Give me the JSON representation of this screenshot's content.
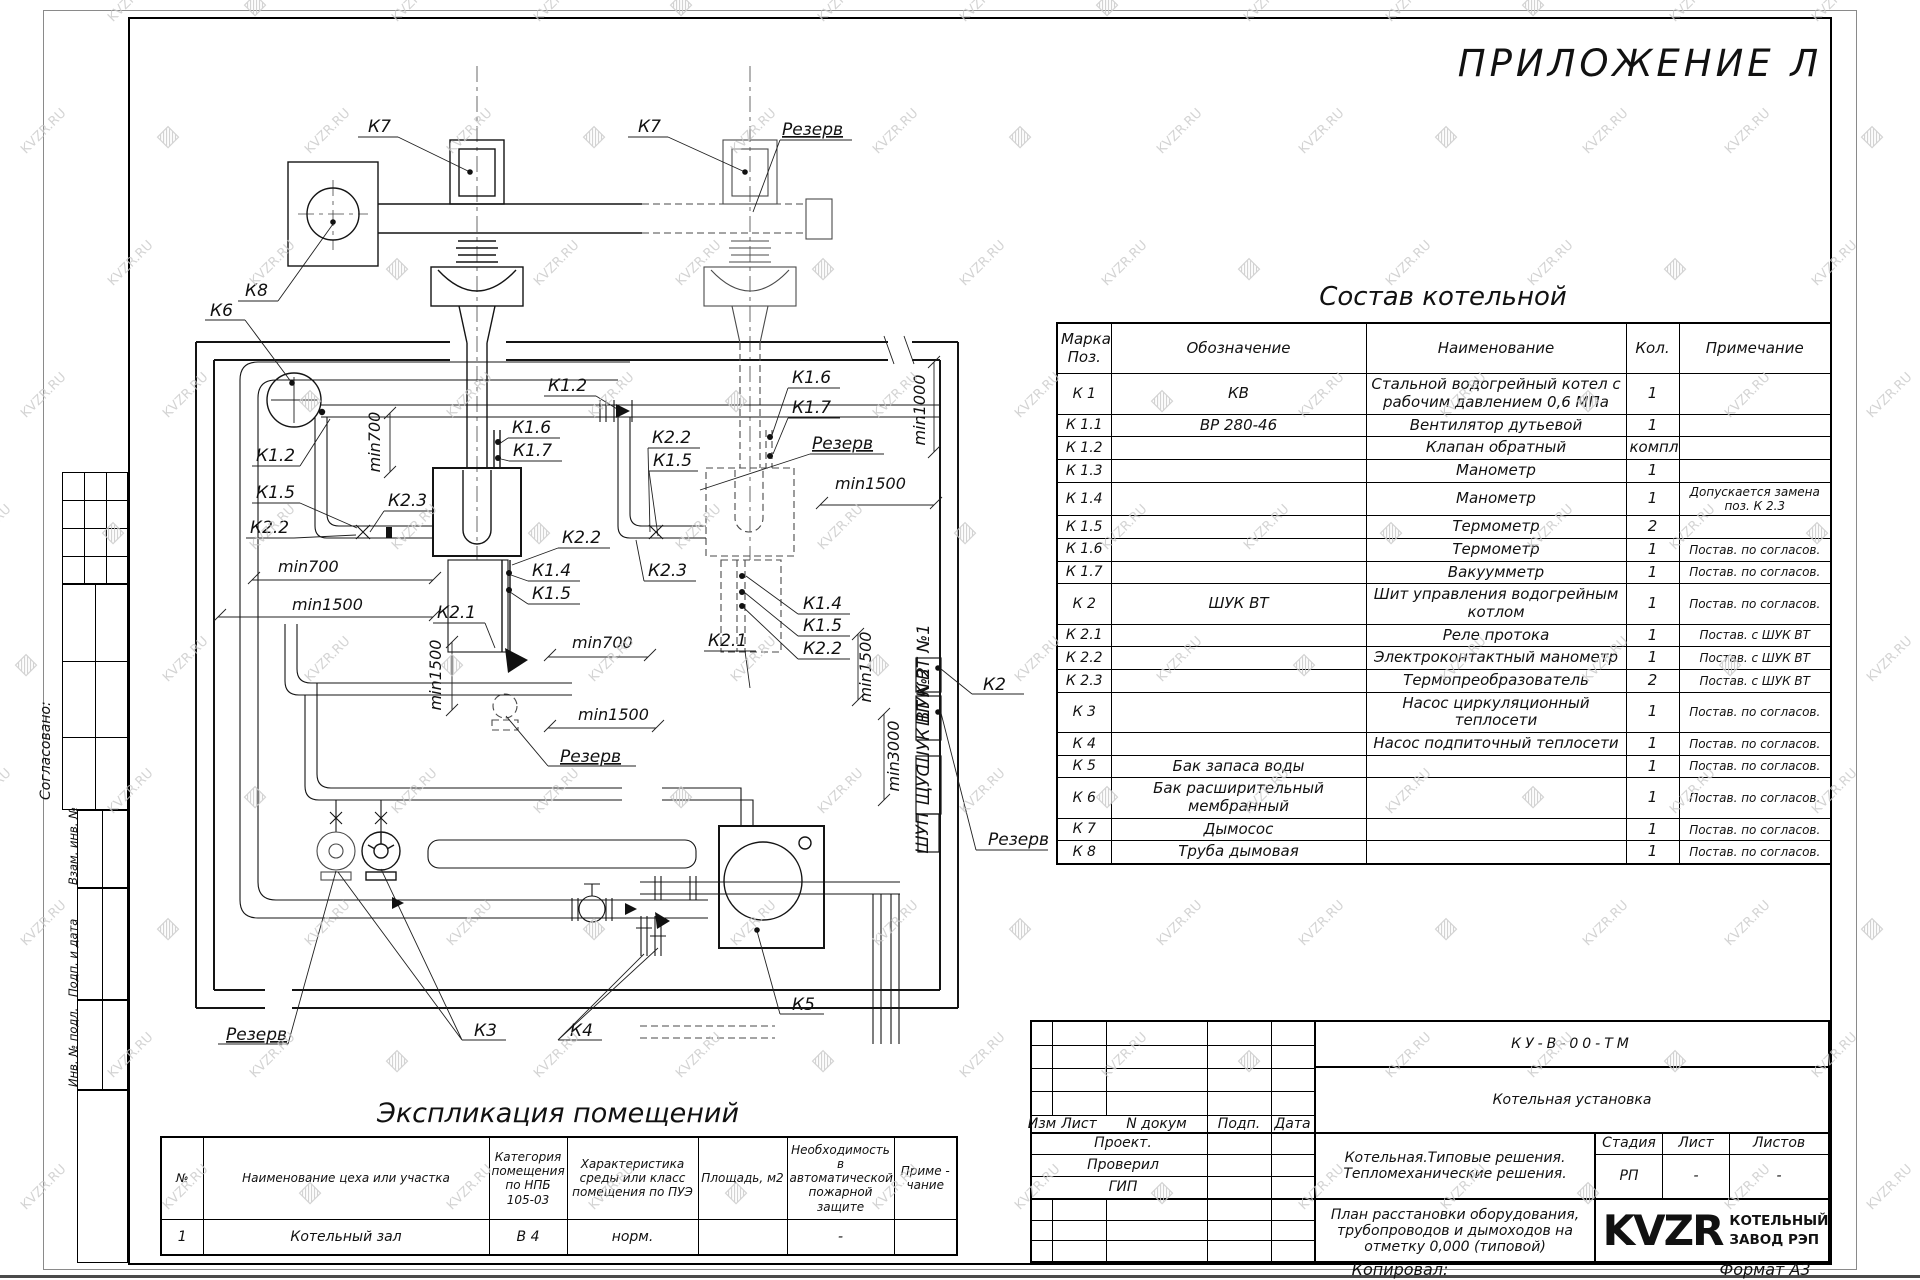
{
  "page": {
    "title": "ПРИЛОЖЕНИЕ Л",
    "copied_label": "Копировал:",
    "format_label": "Формат А3"
  },
  "watermark": {
    "text": "KVZR.RU",
    "color": "#c9c9c9"
  },
  "margin": {
    "agreed": "Согласовано:",
    "replace_inv": "Взам. инв. №",
    "sign_date": "Подп. и дата",
    "inv_orig": "Инв. № подл."
  },
  "composition_table": {
    "title": "Состав котельной",
    "headers": [
      "Марка Поз.",
      "Обозначение",
      "Наименование",
      "Кол.",
      "Примечание"
    ],
    "rows": [
      [
        "К 1",
        "КВ",
        "Стальной водогрейный котел с рабочим давлением 0,6 МПа",
        "1",
        ""
      ],
      [
        "К 1.1",
        "ВР 280-46",
        "Вентилятор дутьевой",
        "1",
        ""
      ],
      [
        "К 1.2",
        "",
        "Клапан обратный",
        "компл.",
        ""
      ],
      [
        "К 1.3",
        "",
        "Манометр",
        "1",
        ""
      ],
      [
        "К 1.4",
        "",
        "Манометр",
        "1",
        "Допускается замена поз. К 2.3"
      ],
      [
        "К 1.5",
        "",
        "Термометр",
        "2",
        ""
      ],
      [
        "К 1.6",
        "",
        "Термометр",
        "1",
        "Постав. по согласов."
      ],
      [
        "К 1.7",
        "",
        "Вакуумметр",
        "1",
        "Постав. по согласов."
      ],
      [
        "К 2",
        "ШУК ВТ",
        "Шит управления водогрейным котлом",
        "1",
        "Постав. по согласов."
      ],
      [
        "К 2.1",
        "",
        "Реле протока",
        "1",
        "Постав. с ШУК ВТ"
      ],
      [
        "К 2.2",
        "",
        "Электроконтактный манометр",
        "1",
        "Постав. с ШУК ВТ"
      ],
      [
        "К 2.3",
        "",
        "Термопреобразователь",
        "2",
        "Постав. с ШУК ВТ"
      ],
      [
        "К 3",
        "",
        "Насос циркуляционный теплосети",
        "1",
        "Постав. по согласов."
      ],
      [
        "К 4",
        "",
        "Насос подпиточный теплосети",
        "1",
        "Постав. по согласов."
      ],
      [
        "К 5",
        "Бак запаса воды",
        "",
        "1",
        "Постав. по согласов."
      ],
      [
        "К 6",
        "Бак расширительный мембранный",
        "",
        "1",
        "Постав. по согласов."
      ],
      [
        "К 7",
        "Дымосос",
        "",
        "1",
        "Постав. по согласов."
      ],
      [
        "К 8",
        "Труба дымовая",
        "",
        "1",
        "Постав. по согласов."
      ]
    ]
  },
  "explication_table": {
    "title": "Экспликация помещений",
    "headers": [
      "№",
      "Наименование цеха или участка",
      "Категория помещения по НПБ 105-03",
      "Характеристика среды или класс помещения по ПУЭ",
      "Площадь, м2",
      "Необходимость в автоматической пожарной защите",
      "Приме - чание"
    ],
    "rows": [
      [
        "1",
        "Котельный зал",
        "В 4",
        "норм.",
        "",
        "-",
        ""
      ]
    ]
  },
  "title_block": {
    "doc_code": "КУ-В-00-ТМ",
    "object_name": "Котельная установка",
    "change_headers": [
      "Изм",
      "Лист",
      "N докум",
      "Подп.",
      "Дата"
    ],
    "roles": [
      "Проект.",
      "Проверил",
      "ГИП"
    ],
    "project_lines": [
      "Котельная.Типовые решения.",
      "Тепломеханические решения."
    ],
    "stage_headers": [
      "Стадия",
      "Лист",
      "Листов"
    ],
    "stage_values": [
      "РП",
      "-",
      "-"
    ],
    "sheet_title_lines": [
      "План расстановки оборудования,",
      "трубопроводов и дымоходов на",
      "отметку 0,000 (типовой)"
    ],
    "logo_text": "KVZR",
    "company_lines": [
      "КОТЕЛЬНЫЙ",
      "ЗАВОД РЭП"
    ]
  },
  "plan": {
    "labels": [
      {
        "t": "К7",
        "x": 368,
        "y": 132
      },
      {
        "t": "К7",
        "x": 638,
        "y": 132
      },
      {
        "t": "Резерв",
        "x": 782,
        "y": 135,
        "u": 1
      },
      {
        "t": "К8",
        "x": 245,
        "y": 296
      },
      {
        "t": "К6",
        "x": 210,
        "y": 316
      },
      {
        "t": "К1.2",
        "x": 256,
        "y": 461
      },
      {
        "t": "К1.5",
        "x": 256,
        "y": 498
      },
      {
        "t": "К2.2",
        "x": 250,
        "y": 533
      },
      {
        "t": "min700",
        "x": 278,
        "y": 572,
        "d": 1
      },
      {
        "t": "min1500",
        "x": 292,
        "y": 610,
        "d": 1
      },
      {
        "t": "К2.3",
        "x": 388,
        "y": 506
      },
      {
        "t": "min700",
        "x": 380,
        "y": 442,
        "d": 1,
        "r": -90
      },
      {
        "t": "К1.6",
        "x": 512,
        "y": 433
      },
      {
        "t": "К1.7",
        "x": 513,
        "y": 456
      },
      {
        "t": "К1.2",
        "x": 548,
        "y": 391
      },
      {
        "t": "К2.2",
        "x": 562,
        "y": 543
      },
      {
        "t": "К1.4",
        "x": 532,
        "y": 576
      },
      {
        "t": "К1.5",
        "x": 532,
        "y": 599
      },
      {
        "t": "К2.1",
        "x": 437,
        "y": 618
      },
      {
        "t": "min700",
        "x": 572,
        "y": 648,
        "d": 1
      },
      {
        "t": "К1.6",
        "x": 792,
        "y": 383
      },
      {
        "t": "К1.7",
        "x": 792,
        "y": 413
      },
      {
        "t": "Резерв",
        "x": 812,
        "y": 449,
        "u": 1
      },
      {
        "t": "min1000",
        "x": 925,
        "y": 410,
        "d": 1,
        "r": -90
      },
      {
        "t": "min1500",
        "x": 835,
        "y": 489,
        "d": 1
      },
      {
        "t": "К2.2",
        "x": 652,
        "y": 443
      },
      {
        "t": "К1.5",
        "x": 653,
        "y": 466
      },
      {
        "t": "К2.3",
        "x": 648,
        "y": 576
      },
      {
        "t": "К2.1",
        "x": 708,
        "y": 646
      },
      {
        "t": "К1.4",
        "x": 803,
        "y": 609
      },
      {
        "t": "К1.5",
        "x": 803,
        "y": 631
      },
      {
        "t": "К2.2",
        "x": 803,
        "y": 654
      },
      {
        "t": "min1500",
        "x": 871,
        "y": 667,
        "d": 1,
        "r": -90
      },
      {
        "t": "К2",
        "x": 983,
        "y": 690
      },
      {
        "t": "min1500",
        "x": 441,
        "y": 675,
        "d": 1,
        "r": -90
      },
      {
        "t": "min1500",
        "x": 578,
        "y": 720,
        "d": 1
      },
      {
        "t": "Резерв",
        "x": 560,
        "y": 762,
        "u": 1
      },
      {
        "t": "min3000",
        "x": 899,
        "y": 756,
        "d": 1,
        "r": -90
      },
      {
        "t": "Резерв",
        "x": 988,
        "y": 845
      },
      {
        "t": "К5",
        "x": 792,
        "y": 1010
      },
      {
        "t": "Резерв",
        "x": 226,
        "y": 1040,
        "u": 1
      },
      {
        "t": "К3",
        "x": 474,
        "y": 1036
      },
      {
        "t": "К4",
        "x": 570,
        "y": 1036
      },
      {
        "t": "ШУК ВТ №1",
        "x": 929,
        "y": 675,
        "r": -90,
        "s": 7
      },
      {
        "t": "ШУК ВТ №2",
        "x": 929,
        "y": 718,
        "r": -90,
        "s": 7
      },
      {
        "t": "ЩУС",
        "x": 929,
        "y": 785,
        "r": -90,
        "s": 10
      },
      {
        "t": "ШУП",
        "x": 928,
        "y": 833,
        "r": -90,
        "s": 10
      }
    ]
  }
}
